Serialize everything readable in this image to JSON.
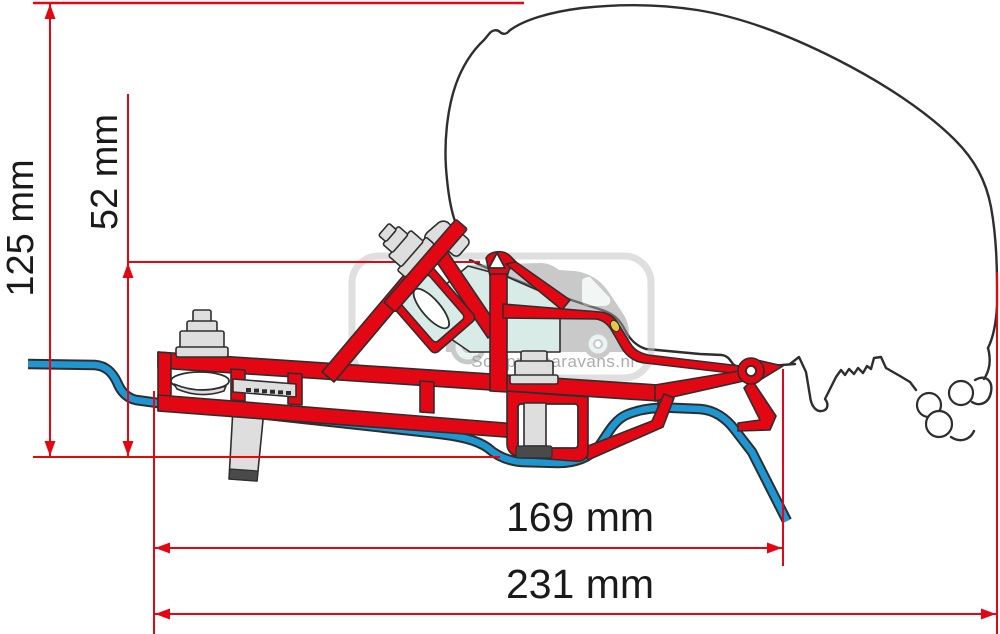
{
  "dimensions": {
    "height_total": {
      "label": "125 mm",
      "value_mm": 125
    },
    "roof_offset": {
      "label": "52 mm",
      "value_mm": 52
    },
    "bracket_width": {
      "label": "169 mm",
      "value_mm": 169
    },
    "overall_width": {
      "label": "231 mm",
      "value_mm": 231
    }
  },
  "watermark": {
    "text": "Schippercaravans.nl"
  },
  "colors": {
    "background": "#ffffff",
    "bracket_red": "#e30613",
    "rail_blue": "#1e96d2",
    "pad_teal": "#d8ebe6",
    "hardware_gray": "#dedede",
    "hardware_dark": "#4a4a4a",
    "outline": "#2e2e2e",
    "dim_red": "#e30613",
    "label_color": "#1a1a1a",
    "watermark_frame": "#c5c5c5",
    "watermark_gray": "#9e9e9e",
    "accent_yellow": "#e6c93c"
  }
}
